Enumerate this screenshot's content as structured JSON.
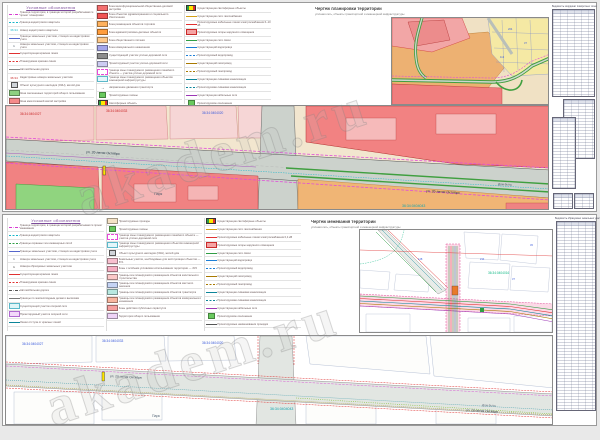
{
  "watermark": {
    "text": "akadem.ru"
  },
  "sheet_top": {
    "legend_title": "Условные обозначения",
    "title": "Чертеж планировки территории",
    "subtitle": "уличная сеть, объекты транспортной и инженерной инфраструктуры",
    "table_caption": "Ведомость координат поворотных точек",
    "legend_col1": [
      {
        "s": {
          "k": "dd",
          "c": "#d63bd0"
        },
        "t": "Граница территории, в границах которой разрабатывается проект планировки"
      },
      {
        "s": {
          "k": "d",
          "c": "#18b6c9"
        },
        "t": "Граница кадастрового квартала"
      },
      {
        "s": {
          "k": "tx",
          "c": "#18b6c9",
          "v": "36:34"
        },
        "t": "Номер кадастрового квартала"
      },
      {
        "s": {
          "k": "l",
          "c": "#5566cc"
        },
        "t": "Границы земельных участков, стоящих на кадастровом учете"
      },
      {
        "s": {
          "k": "tx",
          "c": "#334455",
          "v": "1"
        },
        "t": "Номера земельных участков, стоящих на кадастровом учете"
      },
      {
        "s": {
          "k": "l",
          "c": "#e03131"
        },
        "t": "Существующая красная линия"
      },
      {
        "s": {
          "k": "d",
          "c": "#e03131"
        },
        "t": "Планируемая красная линия"
      },
      {
        "s": {
          "k": "l",
          "c": "#888888"
        },
        "t": "Автомобильная дорога"
      },
      {
        "s": {
          "k": "tx",
          "c": "#c92a2a",
          "v": "36:34"
        },
        "t": "Кадастровые номера земельных участков"
      },
      {
        "s": {
          "k": "ic",
          "c": "#cfd4d9"
        },
        "t": "Объект культурного наследия (ОКН), жилой дом"
      },
      {
        "s": {
          "k": "f",
          "c": "#8ed081"
        },
        "t": "Зона озелененных территорий общего пользования"
      },
      {
        "s": {
          "k": "f",
          "c": "#f58a8a"
        },
        "t": "Зона многоэтажной жилой застройки"
      },
      {
        "s": {
          "k": "f",
          "c": "#f2a0a0"
        },
        "t": "Зона среднеэтажной жилой застройки"
      }
    ],
    "legend_col2": [
      {
        "s": {
          "k": "f",
          "c": "#f47070"
        },
        "t": "Зона многофункциональной общественно-деловой застройки"
      },
      {
        "s": {
          "k": "f",
          "c": "#f05454"
        },
        "t": "Зона объектов здравоохранения и социального обеспечения"
      },
      {
        "s": {
          "k": "f",
          "c": "#ffb25e"
        },
        "t": "Зона размещения объектов торговли"
      },
      {
        "s": {
          "k": "f",
          "c": "#ff9d3d"
        },
        "t": "Зона административно-деловых объектов"
      },
      {
        "s": {
          "k": "f",
          "c": "#ffc98a"
        },
        "t": "Зона общественного питания"
      },
      {
        "s": {
          "k": "f",
          "c": "#a4a6ea"
        },
        "t": "Зона коммунального назначения"
      },
      {
        "s": {
          "k": "f",
          "c": "#8c8c8c"
        },
        "t": "Существующий участок улично-дорожной сети"
      },
      {
        "s": {
          "k": "f",
          "c": "#ccccf2"
        },
        "t": "Проектируемый участок улично-дорожной сети"
      },
      {
        "s": {
          "k": "bd",
          "c": "#e64bd8"
        },
        "t": "Граница зоны планируемого размещения линейного объекта — участка улично-дорожной сети"
      },
      {
        "s": {
          "k": "bx",
          "c": "#5bb8c9",
          "c2": "#e3f6fa"
        },
        "t": "Граница зоны планируемого размещения объектов инженерной инфраструктуры"
      },
      {
        "s": {
          "k": "ar",
          "c": "#333333"
        },
        "t": "Направление движения транспорта"
      },
      {
        "s": {
          "k": "fs",
          "c": "#69c95e"
        },
        "t": "Проектируемые газоны"
      },
      {
        "s": {
          "k": "fl",
          "c": "#ffe600"
        },
        "t": "Светофорные объекты"
      }
    ],
    "legend_col3": [
      {
        "s": {
          "k": "fl",
          "c": "#ffe600"
        },
        "t": "Существующие светофорные объекты"
      },
      {
        "s": {
          "k": "l",
          "c": "#d4a017"
        },
        "t": "Существующие сети газоснабжения"
      },
      {
        "s": {
          "k": "l",
          "c": "#e03131"
        },
        "t": "Проектируемые кабельные линии электроснабжения 6–10 кВ"
      },
      {
        "s": {
          "k": "bx",
          "c": "#c92a2a",
          "c2": "#f5a3a3"
        },
        "t": "Проектируемые опоры наружного освещения"
      },
      {
        "s": {
          "k": "l",
          "c": "#2f9e44"
        },
        "t": "Существующие сети связи"
      },
      {
        "s": {
          "k": "l",
          "c": "#1c7ed6"
        },
        "t": "Существующий водопровод"
      },
      {
        "s": {
          "k": "d",
          "c": "#1c7ed6"
        },
        "t": "Проектируемый водопровод"
      },
      {
        "s": {
          "k": "l",
          "c": "#a87900"
        },
        "t": "Существующий газопровод"
      },
      {
        "s": {
          "k": "d",
          "c": "#a87900"
        },
        "t": "Проектируемый газопровод"
      },
      {
        "s": {
          "k": "l",
          "c": "#0c8599"
        },
        "t": "Существующая ливневая канализация"
      },
      {
        "s": {
          "k": "d",
          "c": "#0c8599"
        },
        "t": "Проектируемая ливневая канализация"
      },
      {
        "s": {
          "k": "l",
          "c": "#9c36b5"
        },
        "t": "Существующие кабельные сети"
      },
      {
        "s": {
          "k": "fs",
          "c": "#69c95e"
        },
        "t": "Проектируемое озеленение"
      },
      {
        "s": {
          "k": "l",
          "c": "#555555"
        },
        "t": "Проектируемое покрытие проезжей части"
      }
    ],
    "map": {
      "street_main": "ул. 20-летия Октября",
      "street_main2": "ул. 20-летия Октября",
      "cad1": "36:34:0404027",
      "cad2": "36:34:0404033",
      "cad3": "36:34:0404020",
      "quarter": "36:34:0404043",
      "park": "Парк",
      "dom_byta": "Дом быта"
    },
    "mapB": {
      "n1": "204",
      "n2": "37",
      "n3": "112"
    }
  },
  "sheet_bottom": {
    "legend_title": "Условные обозначения",
    "title": "Чертеж межевания территории",
    "subtitle": "уличная сеть, объекты транспортной и инженерной инфраструктуры",
    "table_caption": "Ведомость образуемых земельных участков",
    "legend_col1": [
      {
        "s": {
          "k": "dd",
          "c": "#d63bd0"
        },
        "t": "Граница территории, в границах которой разрабатывается проект межевания"
      },
      {
        "s": {
          "k": "d",
          "c": "#18b6c9"
        },
        "t": "Граница кадастрового квартала"
      },
      {
        "s": {
          "k": "d",
          "c": "#2f9e44"
        },
        "t": "Границы охранных зон инженерных сетей"
      },
      {
        "s": {
          "k": "l",
          "c": "#5566cc"
        },
        "t": "Границы земельных участков, стоящих на кадастровом учете"
      },
      {
        "s": {
          "k": "tx",
          "c": "#334455",
          "v": "1"
        },
        "t": "Номера земельных участков, стоящих на кадастровом учете"
      },
      {
        "s": {
          "k": "tx",
          "c": "#111111",
          "v": "1"
        },
        "t": "Номера образуемых земельных участков"
      },
      {
        "s": {
          "k": "l",
          "c": "#e03131"
        },
        "t": "Существующая красная линия"
      },
      {
        "s": {
          "k": "d",
          "c": "#e03131"
        },
        "t": "Планируемая красная линия"
      },
      {
        "s": {
          "k": "dd",
          "c": "#555555"
        },
        "t": "Автомобильная дорога"
      },
      {
        "s": {
          "k": "l",
          "c": "#777777"
        },
        "t": "Границы по землеотводным делам и выпискам"
      },
      {
        "s": {
          "k": "bx",
          "c": "#5bb8c9",
          "c2": "#dff5f8"
        },
        "t": "Существующий участок опорной сети"
      },
      {
        "s": {
          "k": "bx",
          "c": "#b06ad0",
          "c2": "#f3d9fa"
        },
        "t": "Проектируемый участок опорной сети"
      },
      {
        "s": {
          "k": "l",
          "c": "#0c8599"
        },
        "t": "Линии отступа от красных линий"
      }
    ],
    "legend_col2": [
      {
        "s": {
          "k": "f",
          "c": "#f5e3c6"
        },
        "t": "Проектируемые проезды"
      },
      {
        "s": {
          "k": "fs",
          "c": "#69c95e"
        },
        "t": "Проектируемые газоны"
      },
      {
        "s": {
          "k": "bd",
          "c": "#e64bd8"
        },
        "t": "Граница зоны планируемого размещения линейного объекта — участка улично-дорожной сети"
      },
      {
        "s": {
          "k": "bx",
          "c": "#5bb8c9",
          "c2": "#e3f6fa"
        },
        "t": "Граница зоны планируемого размещения объектов инженерной инфраструктуры"
      },
      {
        "s": {
          "k": "ic",
          "c": "#cfd4d9"
        },
        "t": "Объект культурного наследия (ОКН), жилой дом"
      },
      {
        "s": {
          "k": "f",
          "c": "#f8c0cf"
        },
        "t": "Земельные участки, необходимые для эксплуатации объектов — ЗУ1"
      },
      {
        "s": {
          "k": "f",
          "c": "#f6aec2"
        },
        "t": "Зоны с особыми условиями использования территории — ЗУ2"
      },
      {
        "s": {
          "k": "f",
          "c": "#fbc8c8"
        },
        "t": "Границы зон планируемого размещения объектов капитального строительства"
      },
      {
        "s": {
          "k": "f",
          "c": "#c5d4f5"
        },
        "t": "Границы зон планируемого размещения объектов местного значения"
      },
      {
        "s": {
          "k": "f",
          "c": "#b8e8e0"
        },
        "t": "Границы зон планируемого размещения объектов транспорта"
      },
      {
        "s": {
          "k": "f",
          "c": "#f8b6a0"
        },
        "t": "Границы зон планируемого размещения объектов коммунального назначения"
      },
      {
        "s": {
          "k": "f",
          "c": "#f59f9f"
        },
        "t": "Зоны действия публичных сервитутов"
      },
      {
        "s": {
          "k": "f",
          "c": "#efd3f7"
        },
        "t": "Территории общего пользования"
      }
    ],
    "legend_col3": [
      {
        "s": {
          "k": "fl",
          "c": "#ffe600"
        },
        "t": "Существующие светофорные объекты"
      },
      {
        "s": {
          "k": "l",
          "c": "#d4a017"
        },
        "t": "Существующие сети газоснабжения"
      },
      {
        "s": {
          "k": "l",
          "c": "#e03131"
        },
        "t": "Проектируемые кабельные линии электроснабжения 0,4 кВ"
      },
      {
        "s": {
          "k": "bx",
          "c": "#c92a2a",
          "c2": "#f5a3a3"
        },
        "t": "Проектируемые опоры наружного освещения"
      },
      {
        "s": {
          "k": "l",
          "c": "#2f9e44"
        },
        "t": "Существующие сети связи"
      },
      {
        "s": {
          "k": "l",
          "c": "#1c7ed6"
        },
        "t": "Существующий водопровод"
      },
      {
        "s": {
          "k": "d",
          "c": "#1c7ed6"
        },
        "t": "Проектируемый водопровод"
      },
      {
        "s": {
          "k": "l",
          "c": "#a87900"
        },
        "t": "Существующий газопровод"
      },
      {
        "s": {
          "k": "d",
          "c": "#a87900"
        },
        "t": "Проектируемый газопровод"
      },
      {
        "s": {
          "k": "l",
          "c": "#0c8599"
        },
        "t": "Существующая ливневая канализация"
      },
      {
        "s": {
          "k": "d",
          "c": "#0c8599"
        },
        "t": "Проектируемая ливневая канализация"
      },
      {
        "s": {
          "k": "l",
          "c": "#9c36b5"
        },
        "t": "Существующие кабельные сети"
      },
      {
        "s": {
          "k": "fs",
          "c": "#69c95e"
        },
        "t": "Проектируемое озеленение"
      },
      {
        "s": {
          "k": "l",
          "c": "#555555"
        },
        "t": "Проектируемые наименования проездов"
      }
    ],
    "mapC": {
      "quarter": "36:34:0404016",
      "n1": "214",
      "n2": "37",
      "n3": "128",
      "n4": "45"
    },
    "map": {
      "street_main": "ул. 20-летия Октября",
      "street_main2": "ул. 20-летия Октября",
      "cad1": "36:34:0404027",
      "cad2": "36:34:0404033",
      "cad3": "36:34:0404020",
      "quarter": "36:34:0404043",
      "park": "Парк",
      "dom_byta": "Дом быта"
    }
  }
}
